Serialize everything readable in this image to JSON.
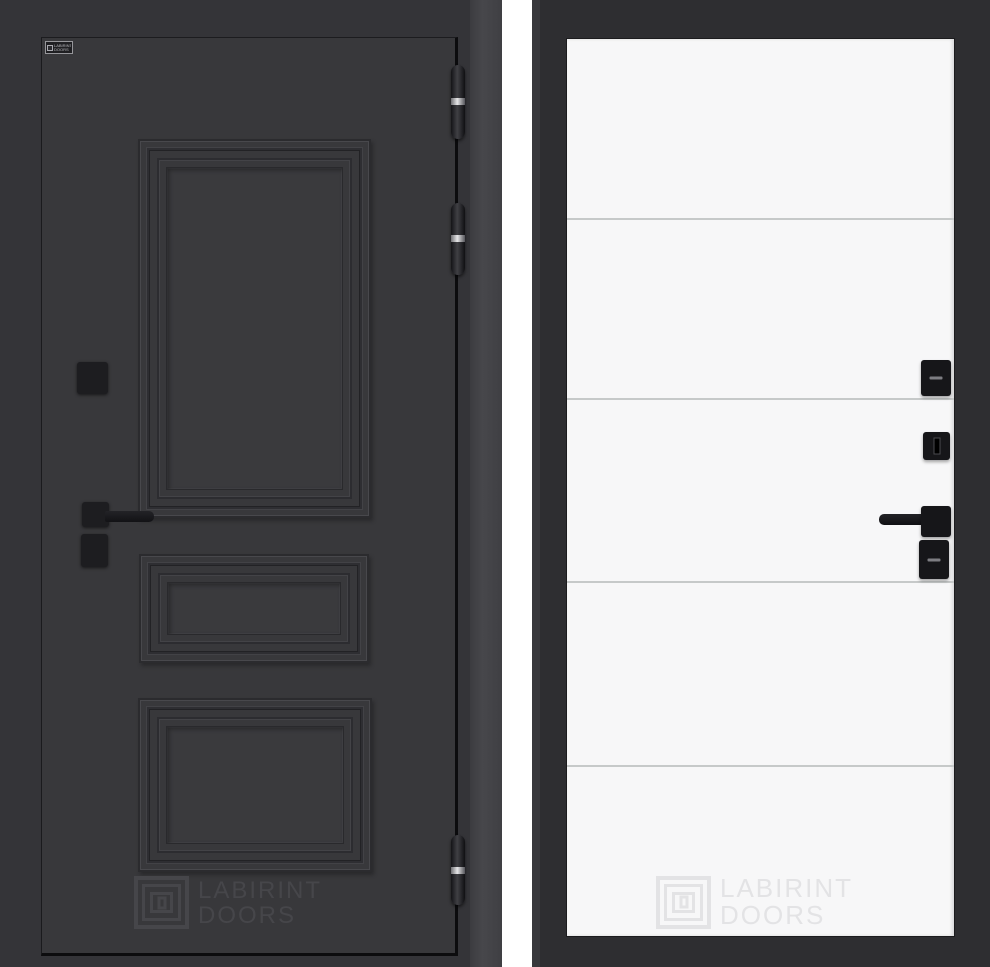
{
  "theme": {
    "left-frame": "#343438",
    "left-casing": "#47474b",
    "left-leaf": "#38383b",
    "right-frame": "#2e2e31",
    "right-leaf": "#f7f7f8",
    "groove": "#c6c9c9",
    "hardware-dark": "#1d1d20",
    "hardware-dark2": "#161619",
    "hinge-silver": "#e6e6e8",
    "wm-dark": "#46464a",
    "wm-light": "#e3e3e5"
  },
  "left_door": {
    "brand_plate": {
      "text": "LABIRINT DOORS"
    },
    "watermark": {
      "line1": "LABIRINT",
      "line2": "DOORS"
    }
  },
  "right_door": {
    "watermark": {
      "line1": "LABIRINT",
      "line2": "DOORS"
    }
  }
}
